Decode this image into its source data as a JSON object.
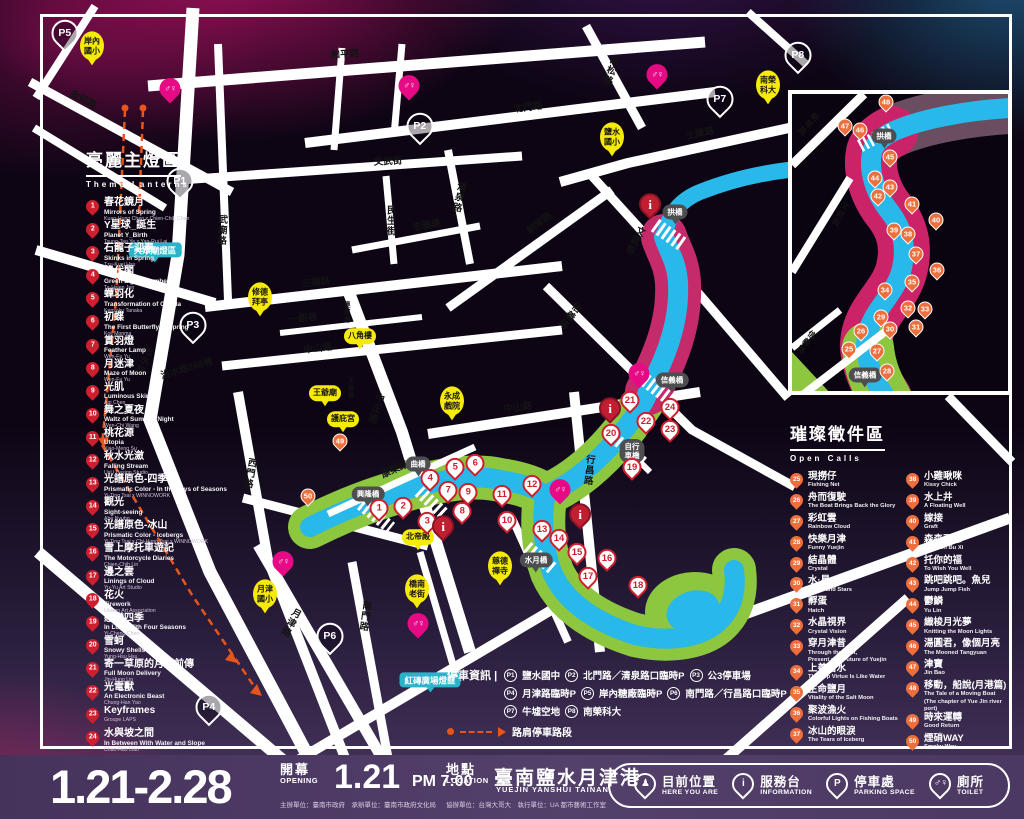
{
  "theme_panel": {
    "title_zh": "亮麗主燈區",
    "title_en": "Theme Lanterns",
    "items": [
      {
        "n": 1,
        "zh": "春花鏡月",
        "en": "Mirrors of Spring",
        "by": "Kuan-Hung Chen x Chien-Chih Chen"
      },
      {
        "n": 2,
        "zh": "Y星球_誕生",
        "en": "Planet Y_Birth",
        "by": "Tsung-Tao Ye x Yan-Rui Lai"
      },
      {
        "n": 3,
        "zh": "石龍子迎春",
        "en": "Skinks in Spring",
        "by": "Tzu-Kuei Hsu"
      },
      {
        "n": 4,
        "zh": "綠代閣",
        "en": "Green Light Chamber",
        "by": "Ta-Hsien Jen"
      },
      {
        "n": 5,
        "zh": "蟬羽化",
        "en": "Transformation of Cicada",
        "by": "Kensaku Tanaka"
      },
      {
        "n": 6,
        "zh": "初蝶",
        "en": "The First Butterfly in Spring",
        "by": "Koji Monma"
      },
      {
        "n": 7,
        "zh": "賞羽燈",
        "en": "Feather Lamp",
        "by": "Wen-Fu Yu"
      },
      {
        "n": 8,
        "zh": "月迷津",
        "en": "Maze of Moon",
        "by": "Wen-Fu Yu"
      },
      {
        "n": 9,
        "zh": "光肌",
        "en": "Luminous Skin",
        "by": "Agi Chen"
      },
      {
        "n": 10,
        "zh": "舞之夏夜",
        "en": "Waltz of Summer Night",
        "by": "Wen-Chi Wang"
      },
      {
        "n": 11,
        "zh": "桃花源",
        "en": "Utopia",
        "by": "Xiao-Meng Su"
      },
      {
        "n": 12,
        "zh": "秋水光瀲",
        "en": "Falling Stream",
        "by": "UxU Design Studio"
      },
      {
        "n": 13,
        "zh": "光譜原色-四季",
        "en": "Prismatic Color - In the Days of Seasons",
        "by": "Yi-Ting Tsai x WINNOWORK"
      },
      {
        "n": 14,
        "zh": "觀光",
        "en": "Sight-seeing",
        "by": "Abe Nyubo"
      },
      {
        "n": 15,
        "zh": "光譜原色-冰山",
        "en": "Prismatic Color - Icebergs",
        "by": "Yi-Ting Tsai x Chi-Hung Tsai x WINNOWORK"
      },
      {
        "n": 16,
        "zh": "雪上摩托車遊記",
        "en": "The Motorcycle Diaries",
        "by": "Chien-Chih Lin"
      },
      {
        "n": 17,
        "zh": "邊之雲",
        "en": "Linings of Cloud",
        "by": "Yu-Yu Art Studio"
      },
      {
        "n": 18,
        "zh": "花火",
        "en": "Firework",
        "by": "Unison Art Association"
      },
      {
        "n": 19,
        "zh": "戀戀四季",
        "en": "In Love With Four Seasons",
        "by": "Yi-Cheng Chen"
      },
      {
        "n": 20,
        "zh": "雪蚵",
        "en": "Snowy Shells",
        "by": "Yung-Hsu Hsu"
      },
      {
        "n": 21,
        "zh": "寄一草原的月亮前傳",
        "en": "Full Moon Delivery",
        "by": "Jin-Hung Lin"
      },
      {
        "n": 22,
        "zh": "光電獸",
        "en": "An Electronic Beast",
        "by": "Chung-Han Yao"
      },
      {
        "n": 23,
        "zh": "Keyframes",
        "en": "",
        "by": "Groupe LAPS"
      },
      {
        "n": 24,
        "zh": "水與坡之間",
        "en": "In Between With Water and Slope",
        "by": "Chao-Hao Liao"
      }
    ]
  },
  "open_calls_panel": {
    "title_zh": "璀璨徵件區",
    "title_en": "Open Calls",
    "col1": [
      {
        "n": 25,
        "zh": "現撈仔",
        "en": "Fishing Net"
      },
      {
        "n": 26,
        "zh": "舟而復駛",
        "en": "The Boat Brings Back the Glory"
      },
      {
        "n": 27,
        "zh": "彩虹雲",
        "en": "Rainbow Cloud"
      },
      {
        "n": 28,
        "zh": "快樂月津",
        "en": "Funny Yuejin"
      },
      {
        "n": 29,
        "zh": "結晶體",
        "en": "Crystal"
      },
      {
        "n": 30,
        "zh": "水·星",
        "en": "Water and Stars"
      },
      {
        "n": 31,
        "zh": "孵蛋",
        "en": "Hatch"
      },
      {
        "n": 32,
        "zh": "水晶視界",
        "en": "Crystal Vision"
      },
      {
        "n": 33,
        "zh": "穿月津昔",
        "en": "Through the Past,\nPresent and Future of Yuejin"
      },
      {
        "n": 34,
        "zh": "上善若水",
        "en": "The Top Virtue Is Like Water"
      },
      {
        "n": 35,
        "zh": "生命鹽月",
        "en": "Vitality of the Salt Moon"
      },
      {
        "n": 36,
        "zh": "聚波漁火",
        "en": "Colorful Lights on Fishing Boats"
      },
      {
        "n": 37,
        "zh": "冰山的眼淚",
        "en": "The Tears of Iceberg"
      }
    ],
    "col2": [
      {
        "n": 38,
        "zh": "小雞啾咪",
        "en": "Kissy Chick"
      },
      {
        "n": 39,
        "zh": "水上井",
        "en": "A Floating Well"
      },
      {
        "n": 40,
        "zh": "嫁接",
        "en": "Graft"
      },
      {
        "n": 41,
        "zh": "森森不息",
        "en": "Sen Sen Bu Xi"
      },
      {
        "n": 42,
        "zh": "托你的福",
        "en": "To Wish You Well"
      },
      {
        "n": 43,
        "zh": "跳吧跳吧。魚兒",
        "en": "Jump Jump Fish"
      },
      {
        "n": 44,
        "zh": "鬱鱗",
        "en": "Yu Lin"
      },
      {
        "n": 45,
        "zh": "織梭月光夢",
        "en": "Knitting the Moon Lights"
      },
      {
        "n": 46,
        "zh": "湯圓君，像個月亮",
        "en": "The Mooned Tangyuan"
      },
      {
        "n": 47,
        "zh": "津寶",
        "en": "Jin Bao"
      },
      {
        "n": 48,
        "zh": "移動，船說(月港篇)",
        "en": "The Tale of a Moving Boat\n(The chapter of Yue Jin river port)"
      },
      {
        "n": 49,
        "zh": "時來運轉",
        "en": "Good Return"
      },
      {
        "n": 50,
        "zh": "煙硝WAY",
        "en": "Smoky Way"
      }
    ]
  },
  "map": {
    "toilet_glyph": "♂♀",
    "info_glyph": "i",
    "streets": [
      {
        "t": "金和路",
        "x": 83,
        "y": 100,
        "r": 28
      },
      {
        "t": "和平路",
        "x": 345,
        "y": 55,
        "r": -4
      },
      {
        "t": "北門路",
        "x": 528,
        "y": 108,
        "r": -7
      },
      {
        "t": "高松路",
        "x": 610,
        "y": 70,
        "v": 1,
        "r": 18
      },
      {
        "t": "土庫路",
        "x": 700,
        "y": 134,
        "r": -11
      },
      {
        "t": "文武街",
        "x": 388,
        "y": 162,
        "r": -3
      },
      {
        "t": "武廟路",
        "x": 221,
        "y": 230,
        "v": 1,
        "r": 3
      },
      {
        "t": "民生街",
        "x": 390,
        "y": 221,
        "v": 1
      },
      {
        "t": "忠義路",
        "x": 427,
        "y": 226,
        "r": -10
      },
      {
        "t": "清泉路",
        "x": 458,
        "y": 197,
        "v": 1,
        "r": 12
      },
      {
        "t": "朝琴路",
        "x": 540,
        "y": 224,
        "r": -38
      },
      {
        "t": "文武街",
        "x": 634,
        "y": 240,
        "v": 1,
        "r": 28
      },
      {
        "t": "三福路",
        "x": 316,
        "y": 283,
        "r": -7
      },
      {
        "t": "一銀巷",
        "x": 303,
        "y": 319,
        "r": -6
      },
      {
        "t": "中山路",
        "x": 318,
        "y": 349,
        "r": -7
      },
      {
        "t": "連成巷",
        "x": 345,
        "y": 312,
        "v": 1,
        "s": 1
      },
      {
        "t": "治水路268巷",
        "x": 187,
        "y": 369,
        "r": -16
      },
      {
        "t": "治水路",
        "x": 143,
        "y": 360,
        "v": 1,
        "r": 22
      },
      {
        "t": "西門路",
        "x": 249,
        "y": 473,
        "v": 1,
        "r": 10
      },
      {
        "t": "中正路",
        "x": 375,
        "y": 408,
        "v": 1,
        "r": 18
      },
      {
        "t": "王爺巷",
        "x": 349,
        "y": 388,
        "v": 1,
        "s": 1
      },
      {
        "t": "中山路",
        "x": 518,
        "y": 408,
        "r": -7
      },
      {
        "t": "信義路",
        "x": 569,
        "y": 315,
        "v": 1,
        "r": 38
      },
      {
        "t": "康樂路",
        "x": 395,
        "y": 470,
        "r": -24
      },
      {
        "t": "行昌路",
        "x": 588,
        "y": 470,
        "v": 1,
        "r": 6
      },
      {
        "t": "月津路",
        "x": 290,
        "y": 622,
        "v": 1,
        "r": 28
      },
      {
        "t": "南門路",
        "x": 364,
        "y": 616,
        "v": 1,
        "r": 8
      }
    ],
    "inset_streets": [
      {
        "t": "朝琴路",
        "x": 16,
        "y": 30,
        "v": 1,
        "r": 40
      },
      {
        "t": "文武街",
        "x": 48,
        "y": 120,
        "v": 1,
        "r": 28
      },
      {
        "t": "信義路",
        "x": 14,
        "y": 248,
        "v": 1,
        "r": 35
      }
    ],
    "pins_lantern": [
      {
        "n": 1,
        "x": 379,
        "y": 516
      },
      {
        "n": 2,
        "x": 403,
        "y": 514
      },
      {
        "n": 3,
        "x": 427,
        "y": 529
      },
      {
        "n": 4,
        "x": 430,
        "y": 486
      },
      {
        "n": 5,
        "x": 455,
        "y": 475
      },
      {
        "n": 6,
        "x": 475,
        "y": 471
      },
      {
        "n": 7,
        "x": 448,
        "y": 498
      },
      {
        "n": 8,
        "x": 462,
        "y": 519
      },
      {
        "n": 9,
        "x": 468,
        "y": 500
      },
      {
        "n": 10,
        "x": 507,
        "y": 528
      },
      {
        "n": 11,
        "x": 502,
        "y": 502
      },
      {
        "n": 12,
        "x": 532,
        "y": 492
      },
      {
        "n": 13,
        "x": 542,
        "y": 537
      },
      {
        "n": 14,
        "x": 559,
        "y": 546
      },
      {
        "n": 15,
        "x": 577,
        "y": 560
      },
      {
        "n": 16,
        "x": 607,
        "y": 566
      },
      {
        "n": 17,
        "x": 588,
        "y": 584
      },
      {
        "n": 18,
        "x": 638,
        "y": 593
      },
      {
        "n": 19,
        "x": 632,
        "y": 475
      },
      {
        "n": 20,
        "x": 611,
        "y": 441
      },
      {
        "n": 21,
        "x": 630,
        "y": 408
      },
      {
        "n": 22,
        "x": 646,
        "y": 429
      },
      {
        "n": 23,
        "x": 670,
        "y": 437
      },
      {
        "n": 24,
        "x": 670,
        "y": 415
      }
    ],
    "pins_opencall_main": [
      {
        "n": 49,
        "x": 340,
        "y": 447
      },
      {
        "n": 50,
        "x": 308,
        "y": 502
      }
    ],
    "pins_opencall_inset": [
      {
        "n": 25,
        "x": 57,
        "y": 261
      },
      {
        "n": 26,
        "x": 69,
        "y": 243
      },
      {
        "n": 27,
        "x": 85,
        "y": 263
      },
      {
        "n": 28,
        "x": 95,
        "y": 283
      },
      {
        "n": 29,
        "x": 89,
        "y": 229
      },
      {
        "n": 30,
        "x": 98,
        "y": 241
      },
      {
        "n": 31,
        "x": 124,
        "y": 239
      },
      {
        "n": 32,
        "x": 116,
        "y": 220
      },
      {
        "n": 33,
        "x": 133,
        "y": 221
      },
      {
        "n": 34,
        "x": 93,
        "y": 202
      },
      {
        "n": 35,
        "x": 120,
        "y": 194
      },
      {
        "n": 36,
        "x": 145,
        "y": 182
      },
      {
        "n": 37,
        "x": 124,
        "y": 166
      },
      {
        "n": 38,
        "x": 116,
        "y": 146
      },
      {
        "n": 39,
        "x": 102,
        "y": 142
      },
      {
        "n": 40,
        "x": 144,
        "y": 132
      },
      {
        "n": 41,
        "x": 120,
        "y": 116
      },
      {
        "n": 42,
        "x": 86,
        "y": 108
      },
      {
        "n": 43,
        "x": 98,
        "y": 99
      },
      {
        "n": 44,
        "x": 83,
        "y": 90
      },
      {
        "n": 45,
        "x": 98,
        "y": 69
      },
      {
        "n": 46,
        "x": 68,
        "y": 42
      },
      {
        "n": 47,
        "x": 53,
        "y": 38
      },
      {
        "n": 48,
        "x": 94,
        "y": 14
      }
    ],
    "pins_parking": [
      {
        "t": "P1",
        "x": 180,
        "y": 192
      },
      {
        "t": "P2",
        "x": 420,
        "y": 137
      },
      {
        "t": "P3",
        "x": 193,
        "y": 336
      },
      {
        "t": "P4",
        "x": 209,
        "y": 718
      },
      {
        "t": "P5",
        "x": 65,
        "y": 44
      },
      {
        "t": "P6",
        "x": 330,
        "y": 647
      },
      {
        "t": "P7",
        "x": 720,
        "y": 110
      },
      {
        "t": "P8",
        "x": 798,
        "y": 66
      }
    ],
    "pins_toilet": [
      {
        "x": 170,
        "y": 97
      },
      {
        "x": 409,
        "y": 94
      },
      {
        "x": 657,
        "y": 83
      },
      {
        "x": 639,
        "y": 382
      },
      {
        "x": 560,
        "y": 498
      },
      {
        "x": 283,
        "y": 570
      },
      {
        "x": 418,
        "y": 632
      }
    ],
    "pins_info": [
      {
        "x": 650,
        "y": 213
      },
      {
        "x": 610,
        "y": 417
      },
      {
        "x": 580,
        "y": 523
      },
      {
        "x": 443,
        "y": 535
      }
    ],
    "pins_yellow": [
      {
        "t": "岸內\n國小",
        "x": 92,
        "y": 46
      },
      {
        "t": "南榮\n科大",
        "x": 768,
        "y": 85
      },
      {
        "t": "鹽水\n國小",
        "x": 612,
        "y": 137
      },
      {
        "t": "修德\n拜亭",
        "x": 260,
        "y": 297
      },
      {
        "t": "八角樓",
        "x": 360,
        "y": 336
      },
      {
        "t": "王爺廟",
        "x": 325,
        "y": 393
      },
      {
        "t": "護庇宮",
        "x": 343,
        "y": 419
      },
      {
        "t": "永成\n戲院",
        "x": 452,
        "y": 401
      },
      {
        "t": "北帝殿",
        "x": 418,
        "y": 537
      },
      {
        "t": "慈德\n禪寺",
        "x": 500,
        "y": 566
      },
      {
        "t": "橋南\n老街",
        "x": 417,
        "y": 589
      },
      {
        "t": "月津\n國小",
        "x": 265,
        "y": 594
      }
    ],
    "pins_bridge": [
      {
        "t": "拱橋",
        "x": 675,
        "y": 212
      },
      {
        "t": "信義橋",
        "x": 672,
        "y": 380
      },
      {
        "t": "自行\n車橋",
        "x": 632,
        "y": 451
      },
      {
        "t": "水月橋",
        "x": 536,
        "y": 560
      },
      {
        "t": "曲橋",
        "x": 418,
        "y": 464
      },
      {
        "t": "興隆橋",
        "x": 368,
        "y": 494
      }
    ],
    "inset_bridges": [
      {
        "t": "拱橋",
        "x": 92,
        "y": 42
      },
      {
        "t": "信義橋",
        "x": 73,
        "y": 281
      }
    ],
    "zone_labels": [
      {
        "t": "大眾廟燈區",
        "x": 155,
        "y": 250
      },
      {
        "t": "紅磚廣場燈區",
        "x": 430,
        "y": 680
      }
    ],
    "parking_info": {
      "label": "停車資訊",
      "divider": "|",
      "lines": [
        [
          [
            "P1",
            "鹽水國中"
          ],
          [
            "P2",
            "北門路／清泉路口臨時P"
          ],
          [
            "P3",
            "公3停車場"
          ]
        ],
        [
          [
            "P4",
            "月津路臨時P"
          ],
          [
            "P5",
            "岸內糖廠臨時P"
          ],
          [
            "P6",
            "南門路／行昌路口臨時P"
          ]
        ],
        [
          [
            "P7",
            "牛墟空地"
          ],
          [
            "P8",
            "南榮科大"
          ]
        ]
      ],
      "roadside": "路肩停車路段"
    }
  },
  "footer": {
    "dates": "1.21-2.28",
    "opening_zh": "開幕",
    "opening_en": "OPENING",
    "opening_date": "1.21",
    "opening_time": "PM 7:00",
    "location_zh": "地點",
    "location_en": "LOCATION",
    "location_name": "臺南鹽水月津港",
    "location_en_name": "YUEJIN YANSHUI TAINAN",
    "credits_left": "主辦單位：臺南市政府　承辦單位：臺南市政府文化局",
    "credits_right": "協辦單位：台灣大哥大　執行單位：UA 都市藝術工作室",
    "legend": [
      {
        "icon": "person",
        "zh": "目前位置",
        "en": "HERE YOU ARE"
      },
      {
        "icon": "info",
        "zh": "服務台",
        "en": "INFORMATION"
      },
      {
        "icon": "parking",
        "zh": "停車處",
        "en": "PARKING SPACE"
      },
      {
        "icon": "toilet",
        "zh": "廁所",
        "en": "TOILET"
      }
    ],
    "legend_glyphs": {
      "person": "♟",
      "info": "i",
      "parking": "P",
      "toilet": "♂♀"
    }
  },
  "colors": {
    "river_blue": "#29b8ea",
    "bank_green": "#8dc63f",
    "bank_magenta": "#c52b6b",
    "pin_red": "#ce1f2f",
    "pin_orange": "#ed6f3d",
    "pin_pink": "#e60b85",
    "landmark_yellow": "#f6ea07",
    "zone_cyan": "#2ab4cc",
    "route_orange": "#e8551c"
  }
}
